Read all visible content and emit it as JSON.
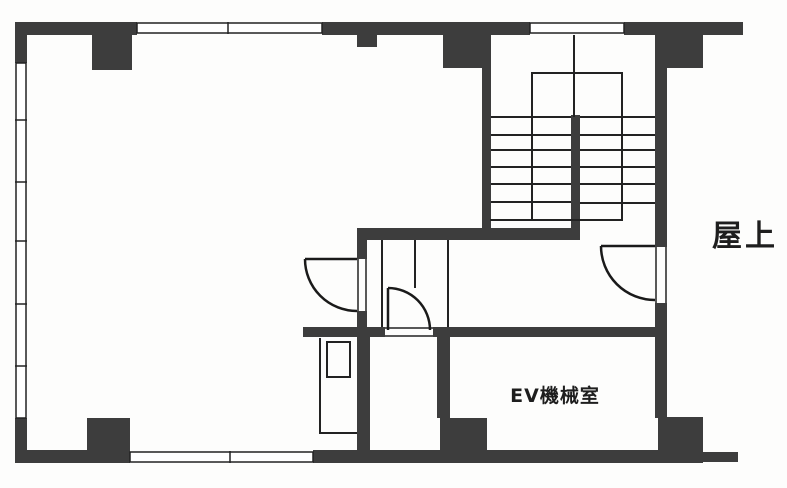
{
  "plan": {
    "type": "floor-plan",
    "labels": [
      {
        "id": "roof",
        "text": "屋上"
      },
      {
        "id": "ev-machine-room",
        "text": "EV機械室"
      }
    ]
  },
  "colors": {
    "wall": "#3d3d3d",
    "line": "#222222",
    "paper": "#fdfdfc"
  }
}
